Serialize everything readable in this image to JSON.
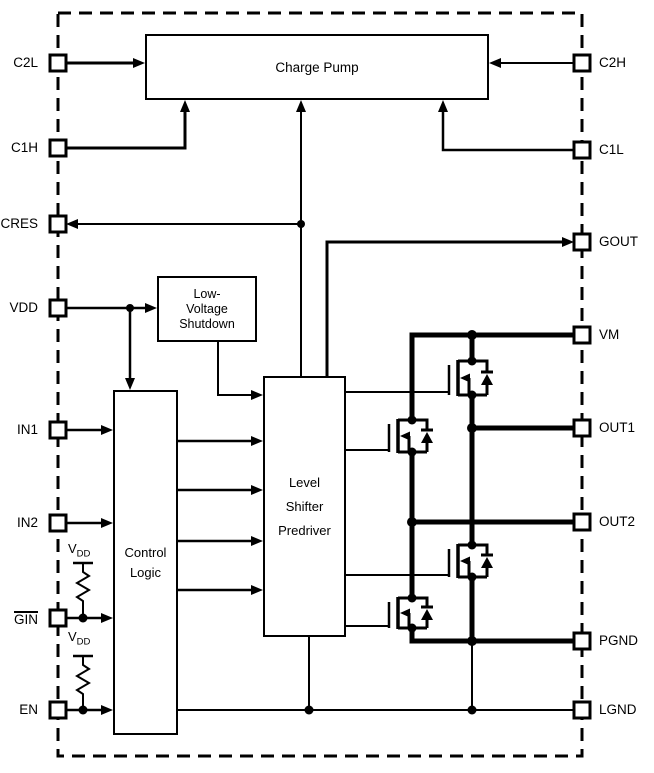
{
  "blocks": {
    "charge_pump": "Charge Pump",
    "low_voltage_shutdown": [
      "Low-",
      "Voltage",
      "Shutdown"
    ],
    "control_logic": [
      "Control",
      "Logic"
    ],
    "level_shifter": [
      "Level",
      "Shifter",
      "Predriver"
    ]
  },
  "pins": {
    "left": [
      "C2L",
      "C1H",
      "CRES",
      "VDD",
      "IN1",
      "IN2",
      "GIN",
      "EN"
    ],
    "right": [
      "C2H",
      "C1L",
      "GOUT",
      "VM",
      "OUT1",
      "OUT2",
      "PGND",
      "LGND"
    ]
  },
  "pullups": {
    "v": "V",
    "sub": "DD"
  },
  "colors": {
    "line": "#000000",
    "background": "#ffffff"
  }
}
